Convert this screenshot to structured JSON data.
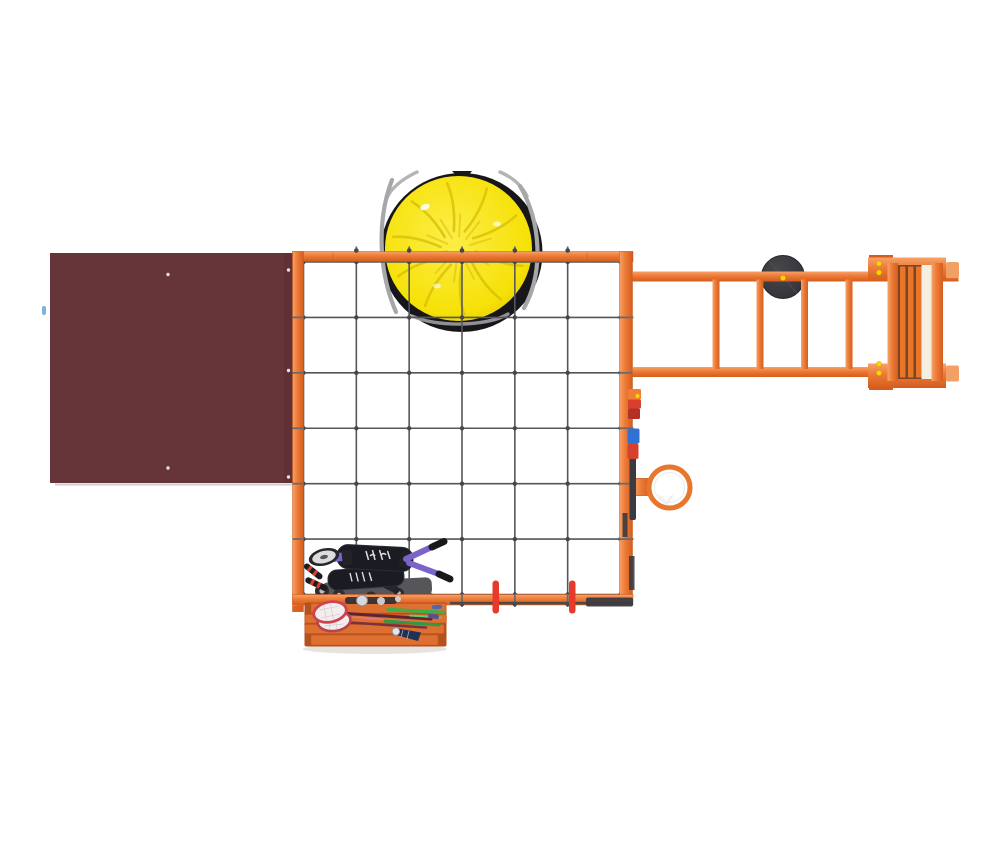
{
  "meta": {
    "description": "Top-down 3D product render of a children's playground climbing structure on a white background: maroon roof panel, orange square frame with rope cargo net, yellow saucer swing, monkey bars with tire disc and access ladder, basketball hoop, activity gadgets, two kick scooters, and a bench with badminton rackets and a shuttlecock"
  },
  "colors": {
    "frame_orange": "#ec7a36",
    "frame_orange_light": "#f7a268",
    "frame_orange_deep": "#d45d1d",
    "frame_edge": "#c6571a",
    "roof_maroon": "#653539",
    "roof_shade": "#5c3136",
    "roof_dot": "#e8dede",
    "net_gray": "#56565a",
    "knot_gray": "#46464b",
    "rope_overwrap": "#6a6a6e",
    "saucer_rim": "#17171b",
    "saucer_yellow": "#f6e107",
    "saucer_yellow_light": "#fcee4a",
    "saucer_crease": "#d8bf06",
    "rope_gray": "#a7a7a9",
    "disc_dark": "#303035",
    "disc_light": "#47474c",
    "bolt_yellow": "#ffd400",
    "hoop_orange": "#e8762c",
    "marker_red": "#e63a2b",
    "gadget_orange": "#ef7f35",
    "gadget_red": "#d8402e",
    "gadget_dark_red": "#b23026",
    "gadget_blue": "#2f72d4",
    "gadget_strip": "#3b3b40",
    "purple": "#7a64c9",
    "deck_black": "#1b1b23",
    "plate_gray": "#55555a",
    "wheel_dark": "#2d2d31",
    "hub_gray": "#b9b9bf",
    "bench_base": "#b4521e",
    "bench_slat": "#dd6f30",
    "racket_red_1": "#ce4352",
    "racket_red_2": "#b84350",
    "mesh_white": "#f3eded",
    "shaft_dark": "#5c2533",
    "shaft_pink": "#e57a8a",
    "rod_green_1": "#3fae48",
    "rod_green_2": "#2f9a44",
    "shuttle_navy": "#223054",
    "shadow_gray": "#e3dedb"
  },
  "net": {
    "columns": 6,
    "rows": 6
  },
  "saucer": {
    "crease_angles": [
      10,
      45,
      80,
      115,
      150,
      185,
      220,
      255,
      290,
      325
    ]
  },
  "components": [
    "roof-panel",
    "saucer-swing",
    "cargo-net",
    "orange-frame",
    "monkey-bars",
    "tire-disc",
    "access-ladder",
    "basketball-hoop",
    "activity-gadgets",
    "red-mount-markers",
    "kick-scooters",
    "picnic-bench",
    "badminton-rackets",
    "shuttlecock"
  ]
}
